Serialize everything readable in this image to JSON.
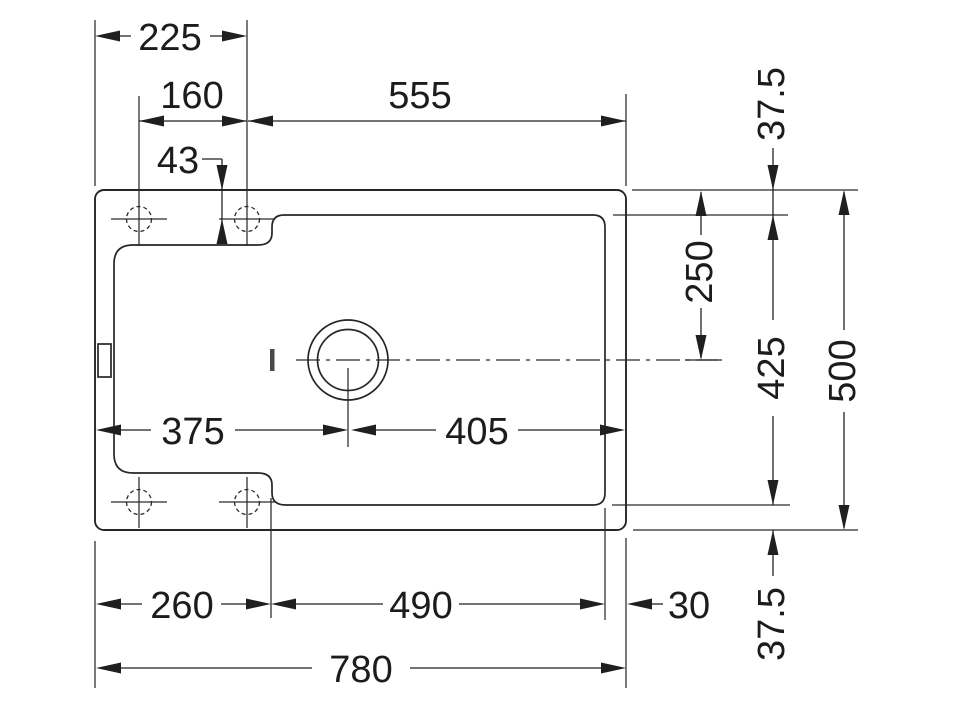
{
  "drawing": {
    "kind": "sink-top-view-dimension-drawing",
    "line_color": "#262626",
    "background": "#ffffff"
  },
  "dimensions": {
    "overall_width": "780",
    "overall_height": "500",
    "left_section_width": "260",
    "bowl_bottom_width": "490",
    "right_margin": "30",
    "tap_ledge_width": "225",
    "tap_hole_spacing": "160",
    "bowl_top_width": "555",
    "tap_hole_offset": "43",
    "drain_from_left": "375",
    "drain_from_right": "405",
    "rim_top": "37.5",
    "rim_bottom": "37.5",
    "bowl_height": "425",
    "drain_center_from_top": "250"
  }
}
